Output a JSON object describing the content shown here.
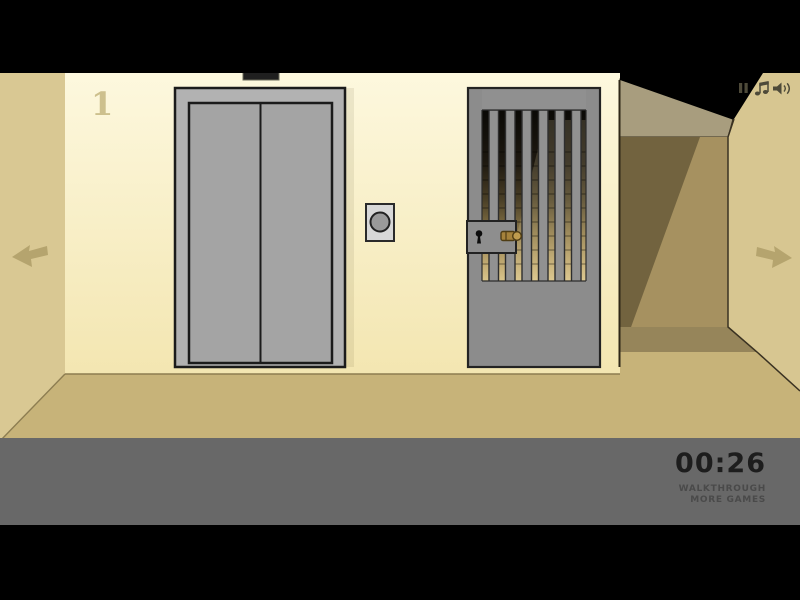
{
  "hud": {
    "timer": "00:26",
    "walkthrough_label": "WALKTHROUGH",
    "more_games_label": "MORE GAMES"
  },
  "scene": {
    "floor_number": "1",
    "objects": {
      "elevator": "closed gray double-door elevator with call button and dark floor indicator",
      "prison_gate": "gray barred gate with lock box, keyhole and inserted gold key",
      "corridor_opening": "shadowed corridor passage on the right",
      "nav_left": "left navigation arrow",
      "nav_right": "right navigation arrow"
    },
    "icons": [
      "pause-icon",
      "music-note-icon",
      "speaker-icon",
      "arrow-left-icon",
      "arrow-right-icon"
    ]
  },
  "colors": {
    "wall_cream_top": "#fdf8de",
    "wall_cream_bottom": "#f3e6b1",
    "side_wall_tan": "#d9c893",
    "floor_tan": "#c7b379",
    "corridor_ceiling": "#a89d7e",
    "corridor_back_wall": "#a69160",
    "corridor_shadow": "#72633f",
    "elevator_frame_gray": "#b2b2b2",
    "elevator_door_gray": "#a4a4a4",
    "gate_gray": "#8d8d8d",
    "key_gold": "#a5823b",
    "arrow_tan": "#b5a46e",
    "hud_bar_gray": "#686868",
    "timer_text": "#1d1d1d",
    "hud_link_text": "#4a4a4a",
    "letterbox_black": "#000000"
  }
}
